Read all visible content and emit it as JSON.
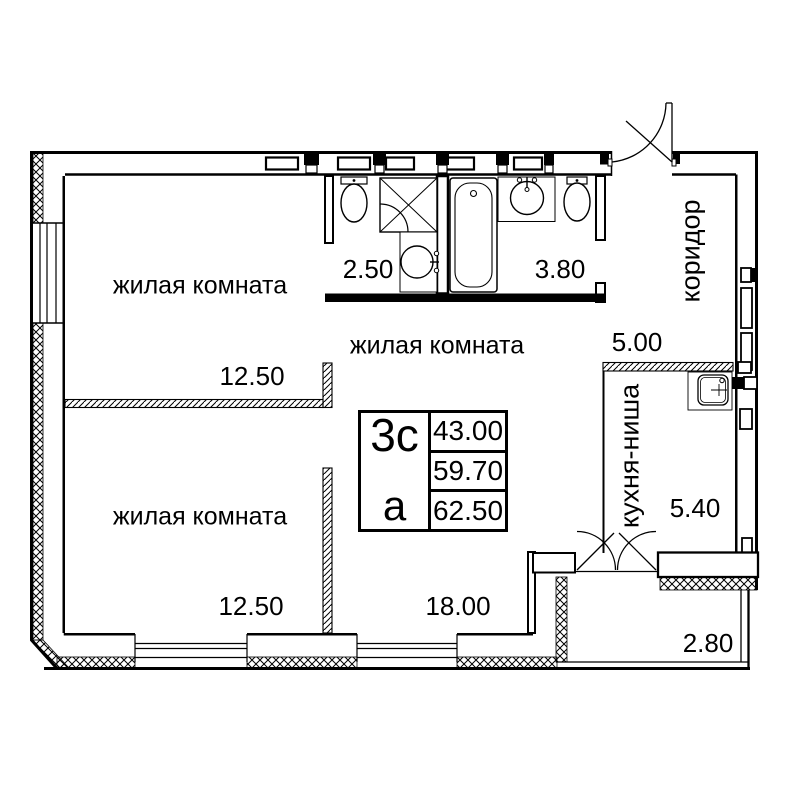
{
  "rooms": {
    "living_top": {
      "label": "жилая комната",
      "area": "12.50"
    },
    "living_mid": {
      "label": "жилая комната",
      "area": "18.00"
    },
    "living_bottom": {
      "label": "жилая комната",
      "area": "12.50"
    },
    "bath_small": {
      "area": "2.50"
    },
    "bath_large": {
      "area": "3.80"
    },
    "corridor": {
      "label": "коридор",
      "area": "5.00"
    },
    "kitchen_niche": {
      "label": "кухня-ниша",
      "area": "5.40"
    },
    "balcony": {
      "area": "2.80"
    }
  },
  "legend": {
    "code": "3с",
    "letter": "а",
    "values": [
      "43.00",
      "59.70",
      "62.50"
    ]
  },
  "colors": {
    "line": "#000000",
    "background": "#ffffff"
  }
}
